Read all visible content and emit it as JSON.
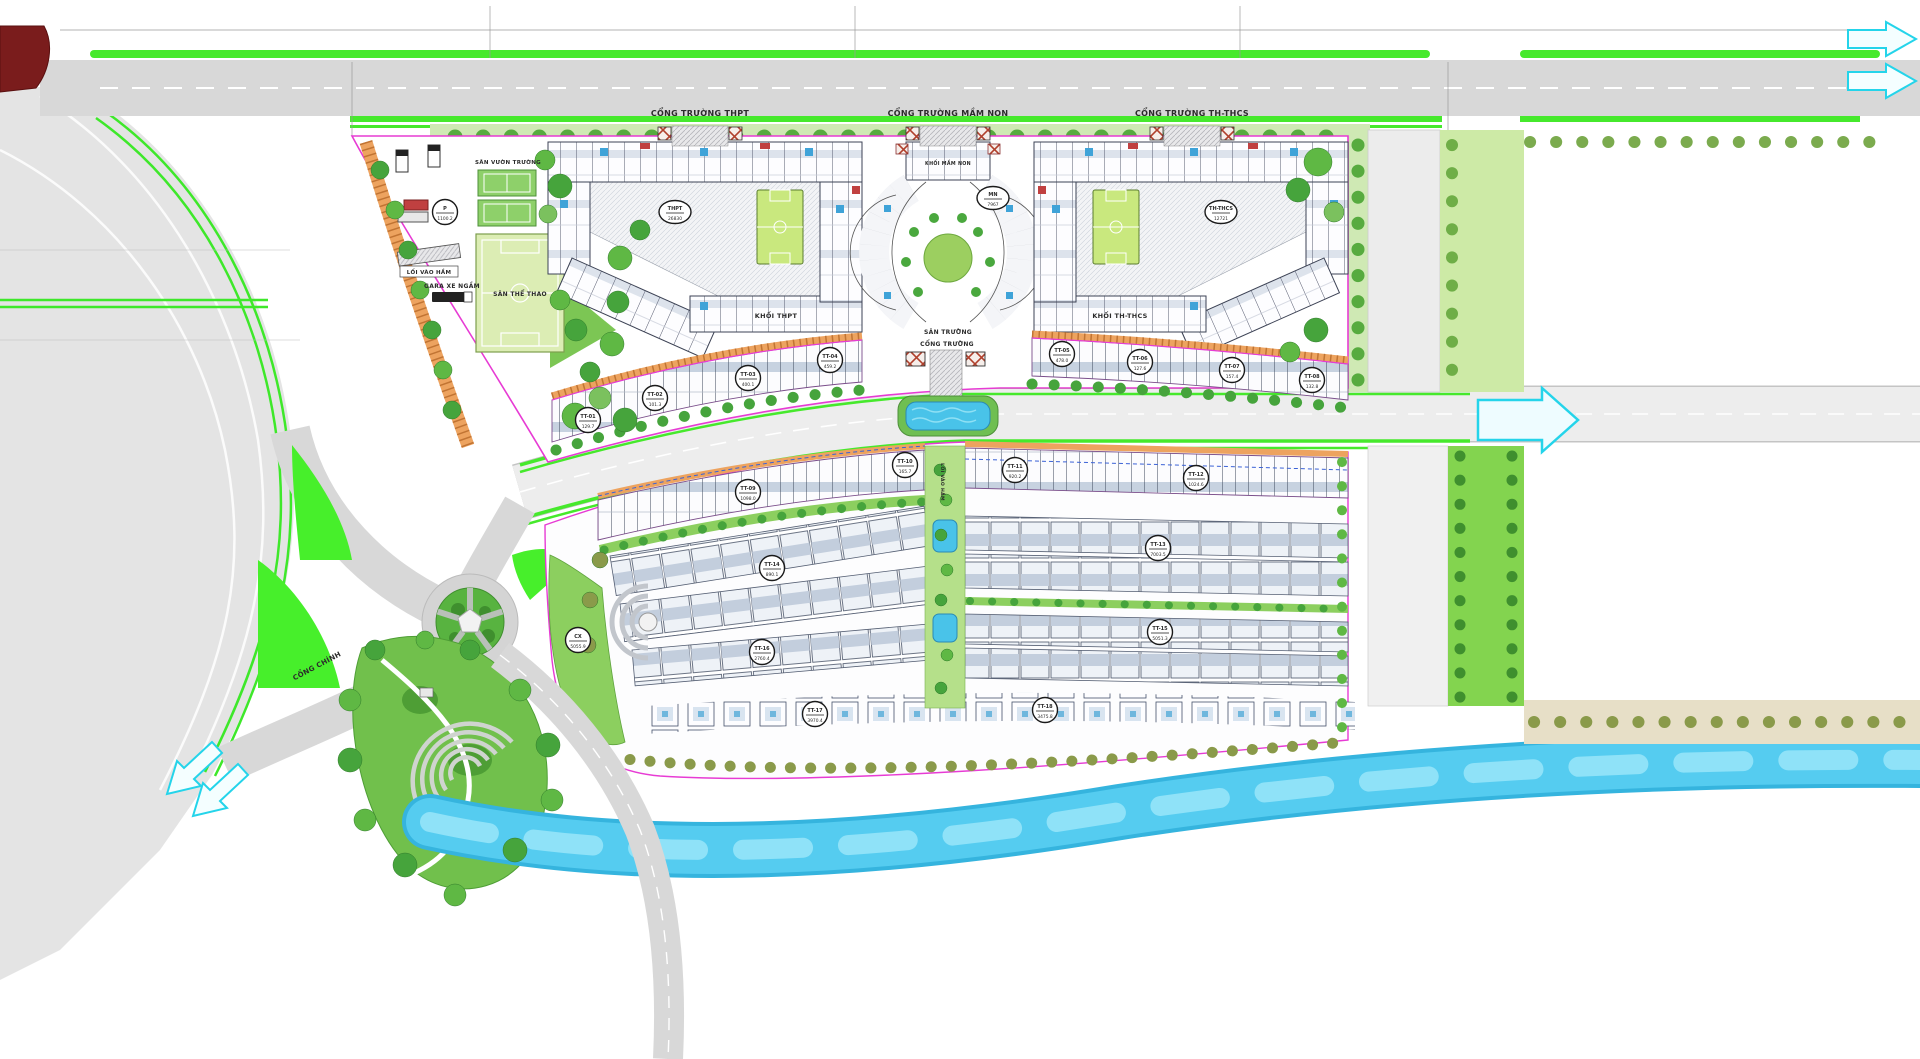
{
  "plan": {
    "labels": {
      "gate_thpt": "CỔNG TRƯỜNG THPT",
      "gate_mn": "CỔNG TRƯỜNG MẦM NON",
      "gate_thcs": "CỔNG TRƯỜNG TH-THCS",
      "garden": "SÂN VƯỜN TRƯỜNG",
      "sport": "SÂN THỂ THAO",
      "ramp": "LỐI VÀO HẦM",
      "garage": "GARA XE NGẦM",
      "khoi_thpt": "KHỐI THPT",
      "khoi_mn": "KHỐI MẦM NON",
      "khoi_thcs": "KHỐI TH-THCS",
      "san_truong": "SÂN TRƯỜNG",
      "cong_truong": "CỔNG TRƯỜNG",
      "cong_chinh": "CỔNG CHÍNH",
      "ramp2": "LỐI VÀO HẦM"
    },
    "badges": [
      {
        "x": 675,
        "y": 212,
        "c": "THPT",
        "a": "26830",
        "s": "ellipse"
      },
      {
        "x": 993,
        "y": 198,
        "c": "MN",
        "a": "7967",
        "s": "ellipse"
      },
      {
        "x": 1221,
        "y": 212,
        "c": "TH-THCS",
        "a": "12721",
        "s": "ellipse"
      },
      {
        "x": 445,
        "y": 212,
        "c": "P",
        "a": "1100.2",
        "s": "circle"
      },
      {
        "x": 578,
        "y": 640,
        "c": "CX",
        "a": "5055.9",
        "s": "circle"
      },
      {
        "x": 588,
        "y": 420,
        "c": "TT-01",
        "a": "129.7",
        "s": "circle"
      },
      {
        "x": 655,
        "y": 398,
        "c": "TT-02",
        "a": "101.3",
        "s": "circle"
      },
      {
        "x": 748,
        "y": 378,
        "c": "TT-03",
        "a": "400.1",
        "s": "circle"
      },
      {
        "x": 830,
        "y": 360,
        "c": "TT-04",
        "a": "459.2",
        "s": "circle"
      },
      {
        "x": 1062,
        "y": 354,
        "c": "TT-05",
        "a": "478.0",
        "s": "circle"
      },
      {
        "x": 1140,
        "y": 362,
        "c": "TT-06",
        "a": "127.6",
        "s": "circle"
      },
      {
        "x": 1232,
        "y": 370,
        "c": "TT-07",
        "a": "157.4",
        "s": "circle"
      },
      {
        "x": 1312,
        "y": 380,
        "c": "TT-08",
        "a": "132.8",
        "s": "circle"
      },
      {
        "x": 748,
        "y": 492,
        "c": "TT-09",
        "a": "1098.0",
        "s": "circle"
      },
      {
        "x": 905,
        "y": 465,
        "c": "TT-10",
        "a": "165.7",
        "s": "circle"
      },
      {
        "x": 1015,
        "y": 470,
        "c": "TT-11",
        "a": "920.2",
        "s": "circle"
      },
      {
        "x": 1196,
        "y": 478,
        "c": "TT-12",
        "a": "1024.6",
        "s": "circle"
      },
      {
        "x": 1158,
        "y": 548,
        "c": "TT-13",
        "a": "7003.5",
        "s": "circle"
      },
      {
        "x": 772,
        "y": 568,
        "c": "TT-14",
        "a": "890.1",
        "s": "circle"
      },
      {
        "x": 1160,
        "y": 632,
        "c": "TT-15",
        "a": "5051.3",
        "s": "circle"
      },
      {
        "x": 762,
        "y": 652,
        "c": "TT-16",
        "a": "2760.4",
        "s": "circle"
      },
      {
        "x": 815,
        "y": 714,
        "c": "TT-17",
        "a": "3970.4",
        "s": "circle"
      },
      {
        "x": 1045,
        "y": 710,
        "c": "TT-18",
        "a": "3475.8",
        "s": "circle"
      }
    ],
    "trees": [
      [
        380,
        170,
        9,
        0
      ],
      [
        395,
        210,
        9,
        1
      ],
      [
        408,
        250,
        9,
        0
      ],
      [
        420,
        290,
        9,
        1
      ],
      [
        432,
        330,
        9,
        0
      ],
      [
        443,
        370,
        9,
        1
      ],
      [
        452,
        410,
        9,
        0
      ],
      [
        545,
        160,
        10,
        1
      ],
      [
        560,
        186,
        12,
        0
      ],
      [
        548,
        214,
        9,
        2
      ],
      [
        620,
        258,
        12,
        1
      ],
      [
        640,
        230,
        10,
        0
      ],
      [
        590,
        372,
        10,
        0
      ],
      [
        575,
        416,
        13,
        1
      ],
      [
        600,
        398,
        11,
        2
      ],
      [
        625,
        420,
        12,
        0
      ],
      [
        612,
        344,
        12,
        1
      ],
      [
        618,
        302,
        11,
        0
      ],
      [
        560,
        300,
        10,
        1
      ],
      [
        576,
        330,
        11,
        0
      ],
      [
        1318,
        162,
        14,
        1
      ],
      [
        1298,
        190,
        12,
        0
      ],
      [
        1334,
        212,
        10,
        2
      ],
      [
        1316,
        330,
        12,
        0
      ],
      [
        1290,
        352,
        10,
        1
      ],
      [
        375,
        650,
        10,
        0
      ],
      [
        350,
        700,
        11,
        1
      ],
      [
        350,
        760,
        12,
        0
      ],
      [
        365,
        820,
        11,
        1
      ],
      [
        405,
        865,
        12,
        0
      ],
      [
        455,
        895,
        11,
        1
      ],
      [
        515,
        850,
        12,
        0
      ],
      [
        552,
        800,
        11,
        1
      ],
      [
        548,
        745,
        12,
        0
      ],
      [
        520,
        690,
        11,
        1
      ],
      [
        470,
        650,
        10,
        0
      ],
      [
        425,
        640,
        9,
        1
      ],
      [
        600,
        560,
        8,
        3
      ],
      [
        590,
        600,
        8,
        3
      ],
      [
        588,
        645,
        8,
        3
      ],
      [
        940,
        470,
        6,
        0
      ],
      [
        946,
        500,
        6,
        1
      ],
      [
        941,
        535,
        6,
        0
      ],
      [
        947,
        570,
        6,
        1
      ],
      [
        941,
        600,
        6,
        0
      ],
      [
        947,
        655,
        6,
        1
      ],
      [
        941,
        688,
        6,
        0
      ]
    ],
    "colors": {
      "road": "#d8d8d8",
      "green_strip": "#46e92c",
      "lawn": "#47ef2b",
      "tree_dark": "#46a43c",
      "field": "#dcedb4",
      "court": "#c9e87e",
      "boundary": "#e73bd4",
      "walk_orange": "#eda35f",
      "water": "#4cc8ee",
      "park": "#71c04c",
      "arrow": "#24d4ea",
      "building": "#3c4254"
    }
  }
}
